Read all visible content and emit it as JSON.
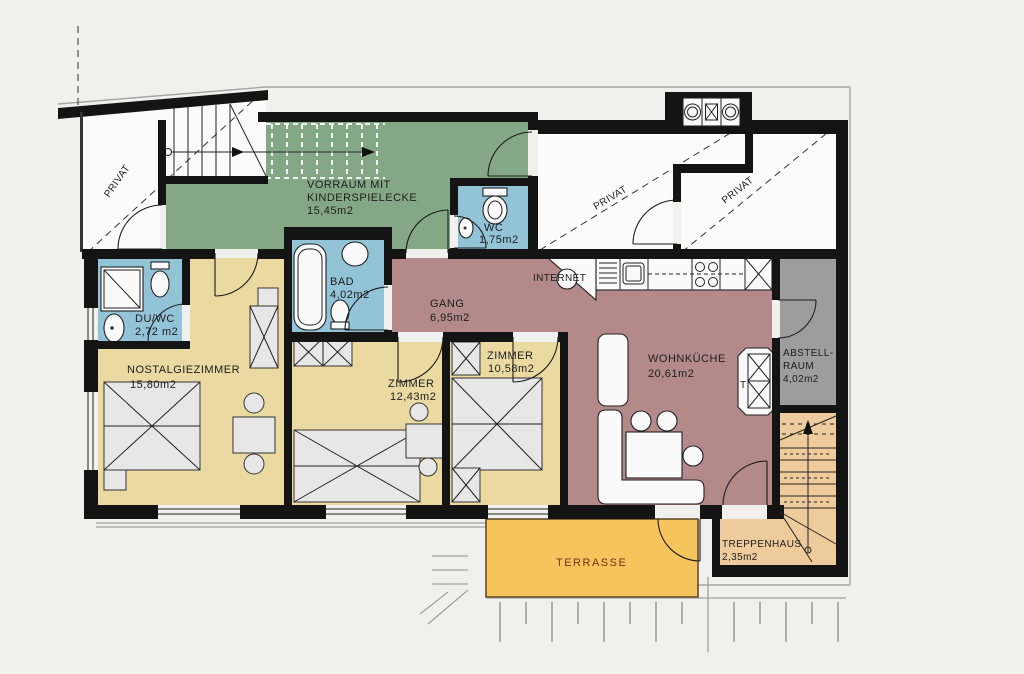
{
  "title": "apartment-floorplan",
  "rooms": {
    "vorraum": {
      "label_line1": "VORRAUM MIT",
      "label_line2": "KINDERSPIELECKE",
      "area": "15,45m2"
    },
    "wc_top": {
      "label": "WC",
      "area": "1,75m2"
    },
    "bad": {
      "label": "BAD",
      "area": "4,02m2"
    },
    "du_wc": {
      "label": "DU/WC",
      "area": "2,72 m2"
    },
    "gang": {
      "label": "GANG",
      "area": "6,95m2"
    },
    "nostalgiezimmer": {
      "label": "NOSTALGIEZIMMER",
      "area": "15,80m2"
    },
    "zimmer_mid": {
      "label": "ZIMMER",
      "area": "12,43m2"
    },
    "zimmer_small": {
      "label": "ZIMMER",
      "area": "10,58m2"
    },
    "wohnkueche": {
      "label": "WOHNKÜCHE",
      "area": "20,61m2"
    },
    "abstellraum": {
      "label_line1": "ABSTELL-",
      "label_line2": "RAUM",
      "area": "4,02m2"
    },
    "treppenhaus": {
      "label": "TREPPENHAUS",
      "area": "2,35m2"
    },
    "terrasse": {
      "label": "TERRASSE"
    }
  },
  "annotations": {
    "privat": "PRIVAT",
    "internet": "INTERNET",
    "stove_t": "T"
  },
  "colors": {
    "bg": "#f0f0ee",
    "wall": "#141414",
    "green": "#84a886",
    "blue": "#92c3d6",
    "yellow": "#ead9a0",
    "mauve": "#b38a89",
    "grayroom": "#9d9d9d",
    "tan": "#edcb9c",
    "terrasse": "#f6c45d",
    "fixture": "#fafafa",
    "furniture": "#e7e7e7"
  }
}
